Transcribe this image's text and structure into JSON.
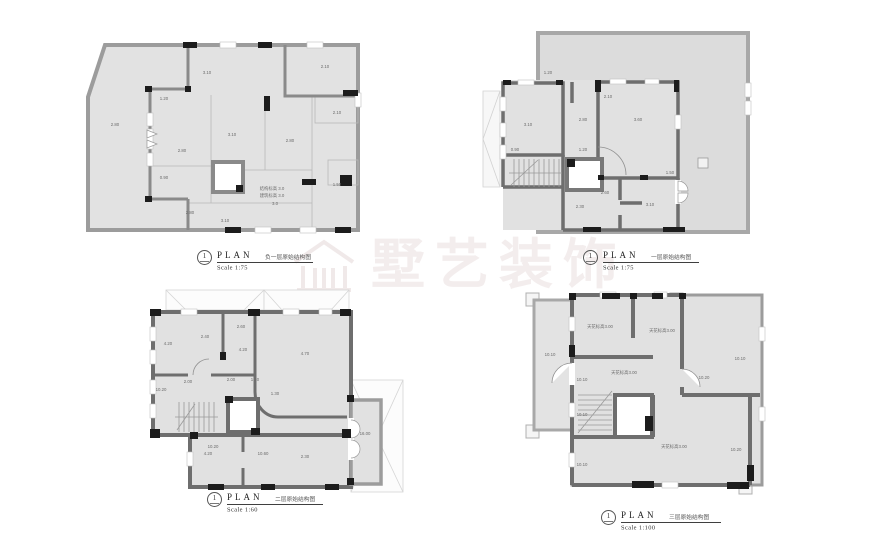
{
  "watermark": {
    "text": "墅艺装饰",
    "logo_icon": "house-logo"
  },
  "plans": {
    "plan1": {
      "title": {
        "number": "1",
        "label": "PLAN",
        "caption": "负一层原始结构图",
        "scale": "Scale 1:75"
      },
      "labels": [
        {
          "t": "2.80",
          "x": 30,
          "y": 92
        },
        {
          "t": "3.10",
          "x": 122,
          "y": 40
        },
        {
          "t": "2.10",
          "x": 240,
          "y": 34
        },
        {
          "t": "1.20",
          "x": 79,
          "y": 66
        },
        {
          "t": "2.80",
          "x": 97,
          "y": 118
        },
        {
          "t": "3.10",
          "x": 147,
          "y": 102
        },
        {
          "t": "2.80",
          "x": 205,
          "y": 108
        },
        {
          "t": "2.10",
          "x": 252,
          "y": 80
        },
        {
          "t": "1.50",
          "x": 252,
          "y": 152
        },
        {
          "t": "0.90",
          "x": 79,
          "y": 145
        },
        {
          "t": "2.80",
          "x": 105,
          "y": 180
        },
        {
          "t": "3.10",
          "x": 140,
          "y": 188
        },
        {
          "t": "结构标高 3.0",
          "x": 187,
          "y": 156
        },
        {
          "t": "建筑标高 3.0",
          "x": 187,
          "y": 163
        },
        {
          "t": "3.0",
          "x": 190,
          "y": 171
        }
      ]
    },
    "plan2": {
      "title": {
        "number": "1",
        "label": "PLAN",
        "caption": "一层原始结构图",
        "scale": "Scale 1:75"
      },
      "labels": [
        {
          "t": "3.10",
          "x": 48,
          "y": 100
        },
        {
          "t": "1.20",
          "x": 68,
          "y": 48
        },
        {
          "t": "2.80",
          "x": 103,
          "y": 95
        },
        {
          "t": "3.60",
          "x": 158,
          "y": 95
        },
        {
          "t": "1.20",
          "x": 103,
          "y": 125
        },
        {
          "t": "2.30",
          "x": 100,
          "y": 182
        },
        {
          "t": "3.10",
          "x": 170,
          "y": 180
        },
        {
          "t": "1.50",
          "x": 190,
          "y": 148
        },
        {
          "t": "2.10",
          "x": 128,
          "y": 72
        },
        {
          "t": "0.90",
          "x": 35,
          "y": 125
        },
        {
          "t": "2.60",
          "x": 125,
          "y": 168
        }
      ]
    },
    "plan3": {
      "title": {
        "number": "1",
        "label": "PLAN",
        "caption": "二层原始结构图",
        "scale": "Scale 1:60"
      },
      "labels": [
        {
          "t": "4.20",
          "x": 35,
          "y": 62
        },
        {
          "t": "2.40",
          "x": 72,
          "y": 55
        },
        {
          "t": "2.60",
          "x": 108,
          "y": 45
        },
        {
          "t": "4.20",
          "x": 110,
          "y": 68
        },
        {
          "t": "4.70",
          "x": 172,
          "y": 72
        },
        {
          "t": "10.20",
          "x": 28,
          "y": 108
        },
        {
          "t": "2.00",
          "x": 55,
          "y": 100
        },
        {
          "t": "2.00",
          "x": 98,
          "y": 98
        },
        {
          "t": "1.20",
          "x": 122,
          "y": 98
        },
        {
          "t": "1.30",
          "x": 142,
          "y": 112
        },
        {
          "t": "10.20",
          "x": 80,
          "y": 165
        },
        {
          "t": "4.20",
          "x": 75,
          "y": 172
        },
        {
          "t": "10.60",
          "x": 130,
          "y": 172
        },
        {
          "t": "2.30",
          "x": 172,
          "y": 175
        },
        {
          "t": "16.00",
          "x": 232,
          "y": 152
        }
      ]
    },
    "plan4": {
      "title": {
        "number": "1",
        "label": "PLAN",
        "caption": "三层原始结构图",
        "scale": "Scale 1:100"
      },
      "labels": [
        {
          "t": "天花标高3.00",
          "x": 88,
          "y": 42
        },
        {
          "t": "天花标高3.00",
          "x": 150,
          "y": 46
        },
        {
          "t": "天花标高3.00",
          "x": 112,
          "y": 88
        },
        {
          "t": "天花标高3.00",
          "x": 162,
          "y": 162
        },
        {
          "t": "10.10",
          "x": 38,
          "y": 70
        },
        {
          "t": "10.10",
          "x": 228,
          "y": 74
        },
        {
          "t": "10.20",
          "x": 192,
          "y": 93
        },
        {
          "t": "10.10",
          "x": 70,
          "y": 95
        },
        {
          "t": "10.10",
          "x": 70,
          "y": 130
        },
        {
          "t": "10.20",
          "x": 224,
          "y": 165
        },
        {
          "t": "10.10",
          "x": 70,
          "y": 180
        }
      ]
    }
  }
}
